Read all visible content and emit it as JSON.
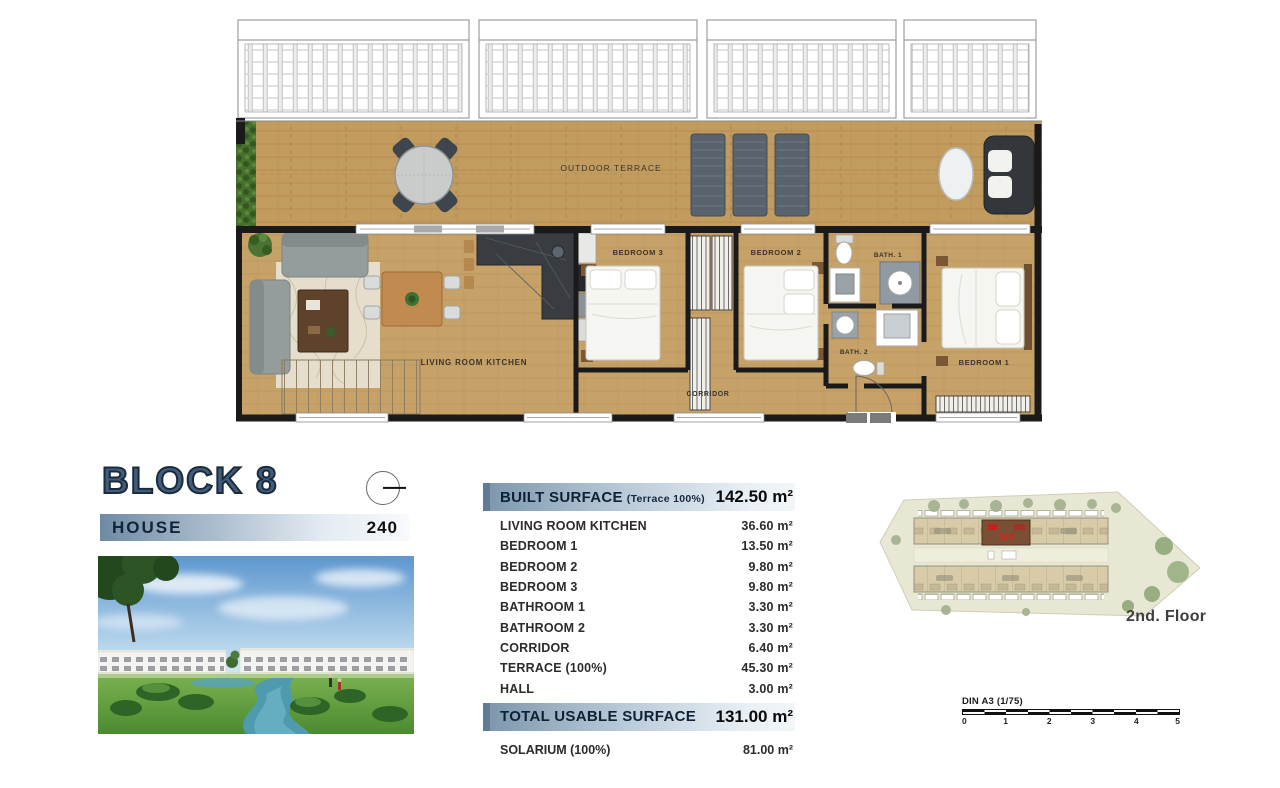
{
  "title": {
    "block": "BLOCK 8",
    "house_label": "HOUSE",
    "house_number": "240"
  },
  "floor_plan": {
    "labels": {
      "outdoor_terrace": "OUTDOOR TERRACE",
      "living_room_kitchen": "LIVING ROOM KITCHEN",
      "bedroom_1": "BEDROOM 1",
      "bedroom_2": "BEDROOM 2",
      "bedroom_3": "BEDROOM 3",
      "bath_1": "BATH. 1",
      "bath_2": "BATH. 2",
      "corridor": "CORRIDOR"
    }
  },
  "surface_table": {
    "header": {
      "label": "BUILT SURFACE",
      "note": "(Terrace 100%)",
      "value": "142.50 m²"
    },
    "rows": [
      {
        "label": "LIVING ROOM KITCHEN",
        "value": "36.60 m²"
      },
      {
        "label": "BEDROOM 1",
        "value": "13.50 m²"
      },
      {
        "label": "BEDROOM 2",
        "value": "9.80 m²"
      },
      {
        "label": "BEDROOM 3",
        "value": "9.80 m²"
      },
      {
        "label": "BATHROOM 1",
        "value": "3.30 m²"
      },
      {
        "label": "BATHROOM 2",
        "value": "3.30 m²"
      },
      {
        "label": "CORRIDOR",
        "value": "6.40 m²"
      },
      {
        "label": "TERRACE (100%)",
        "value": "45.30 m²"
      },
      {
        "label": "HALL",
        "value": "3.00 m²"
      }
    ],
    "total": {
      "label": "TOTAL USABLE SURFACE",
      "value": "131.00 m²"
    },
    "solarium": {
      "label": "SOLARIUM (100%)",
      "value": "81.00 m²"
    }
  },
  "site_plan": {
    "floor_label": "2nd. Floor",
    "highlighted_unit": "240"
  },
  "scale_bar": {
    "label": "DIN A3 (1/75)",
    "ticks": [
      "0",
      "1",
      "2",
      "3",
      "4",
      "5"
    ]
  },
  "colors": {
    "block_title": "#3f5d7d",
    "header_gradient_start": "#6e8ba3",
    "header_gradient_end": "#f2f6f9",
    "wood": "#c6a168",
    "wall": "#1a1a1a",
    "highlight_red": "#c0231d"
  }
}
